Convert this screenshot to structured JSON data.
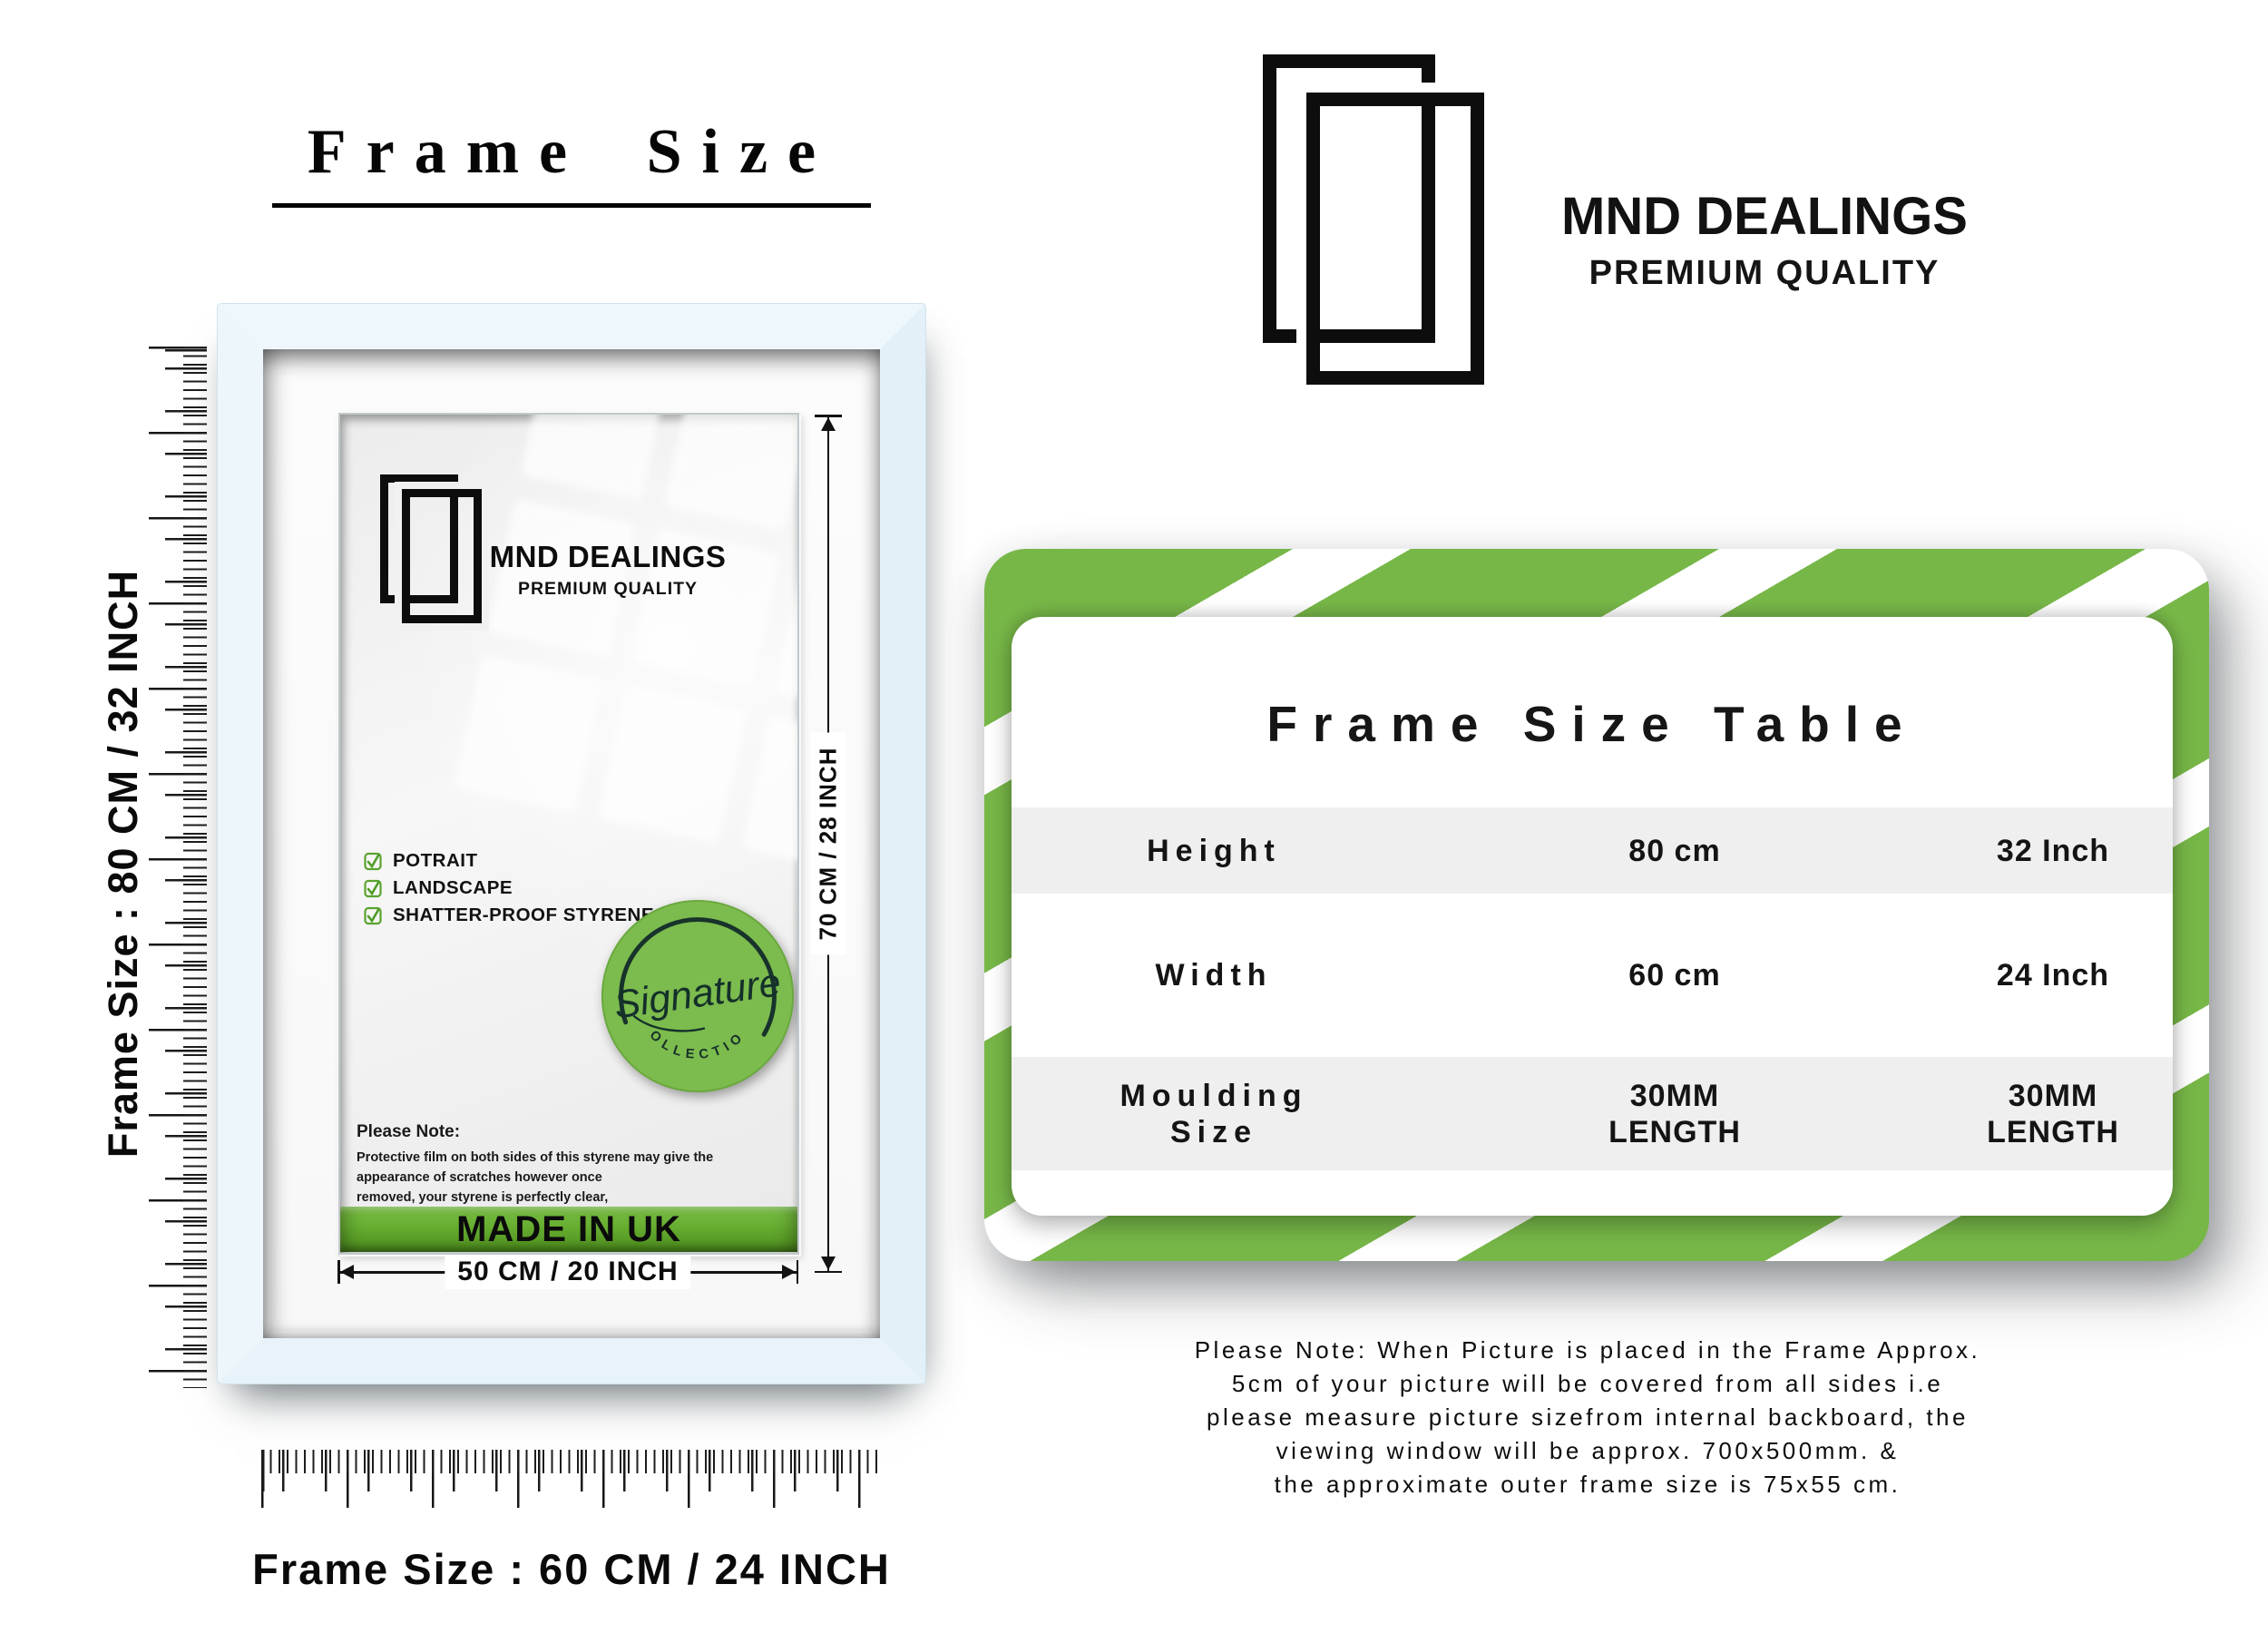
{
  "page": {
    "title": "Frame Size"
  },
  "brand": {
    "name": "MND DEALINGS",
    "tagline": "PREMIUM QUALITY"
  },
  "frame": {
    "left_ruler_label": "Frame Size : 80 CM / 32 INCH",
    "bottom_ruler_label": "Frame Size : 60 CM / 24 INCH",
    "inner_brand": {
      "name": "MND DEALINGS",
      "tagline": "PREMIUM QUALITY"
    },
    "features": [
      {
        "label": "POTRAIT"
      },
      {
        "label": "LANDSCAPE"
      },
      {
        "label": "SHATTER-PROOF STYRENE"
      }
    ],
    "badge": {
      "script": "Signature",
      "arc": "COLLECTION"
    },
    "note": {
      "title": "Please Note:",
      "line1": "Protective film on both sides of this styrene may give the appearance of scratches however once",
      "line2": "removed, your styrene is perfectly clear,"
    },
    "made_in": "MADE IN UK",
    "width_dim": "50 CM / 20 INCH",
    "height_dim": "70 CM / 28 INCH"
  },
  "size_table": {
    "title": "Frame Size Table",
    "rows": [
      {
        "label": "Height",
        "cm": "80 cm",
        "inch": "32 Inch"
      },
      {
        "label": "Width",
        "cm": "60 cm",
        "inch": "24 Inch"
      },
      {
        "label": "Moulding Size",
        "cm": "30MM LENGTH",
        "inch": "30MM LENGTH"
      }
    ]
  },
  "footer_note": {
    "lines": [
      "Please Note: When Picture is placed in the Frame Approx.",
      "5cm of your picture will be covered from all sides i.e",
      "please measure picture sizefrom internal backboard, the",
      "viewing window will be approx. 700x500mm. &",
      "the approximate outer frame size is 75x55 cm."
    ]
  },
  "colors": {
    "accent_green": "#77b748",
    "badge_green": "#7cbb4d",
    "frame_blue": "#eaf5fa",
    "row_gray": "#efefef",
    "made_in_top": "#7abf45",
    "made_in_bottom": "#4c8c1d"
  }
}
